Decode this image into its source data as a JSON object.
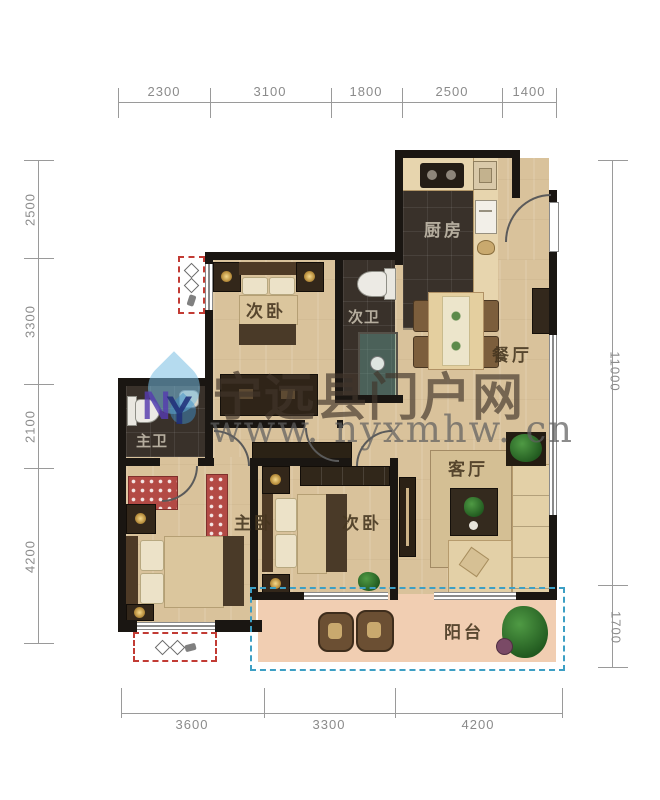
{
  "dimensions": {
    "top": [
      "2300",
      "3100",
      "1800",
      "2500",
      "1400"
    ],
    "left": [
      "2500",
      "3300",
      "2100",
      "4200"
    ],
    "right": [
      "11000",
      "1700"
    ],
    "bottom": [
      "3600",
      "3300",
      "4200"
    ]
  },
  "rooms": {
    "kitchen": "厨房",
    "bedroom_top": "次卧",
    "bath_secondary": "次卫",
    "dining": "餐厅",
    "bath_master": "主卫",
    "bedroom_master": "主卧",
    "bedroom_second": "次卧",
    "living": "客厅",
    "balcony": "阳台"
  },
  "watermark": {
    "site_name": "宁远县门户网",
    "site_url": "www. nyxmhw. cn",
    "logo_n": "N",
    "logo_y": "Y"
  },
  "colors": {
    "wall": "#1a1612",
    "wood_floor": "#d9c29b",
    "dark_tile": "#39312a",
    "balcony_floor": "#f1ceb2",
    "bay_window_dash": "#c23b34",
    "balcony_dash": "#3d9fc4",
    "dimension_text": "#8b8b8b",
    "watermark_text": "#42352a",
    "logo_blue": "#78bde2"
  }
}
